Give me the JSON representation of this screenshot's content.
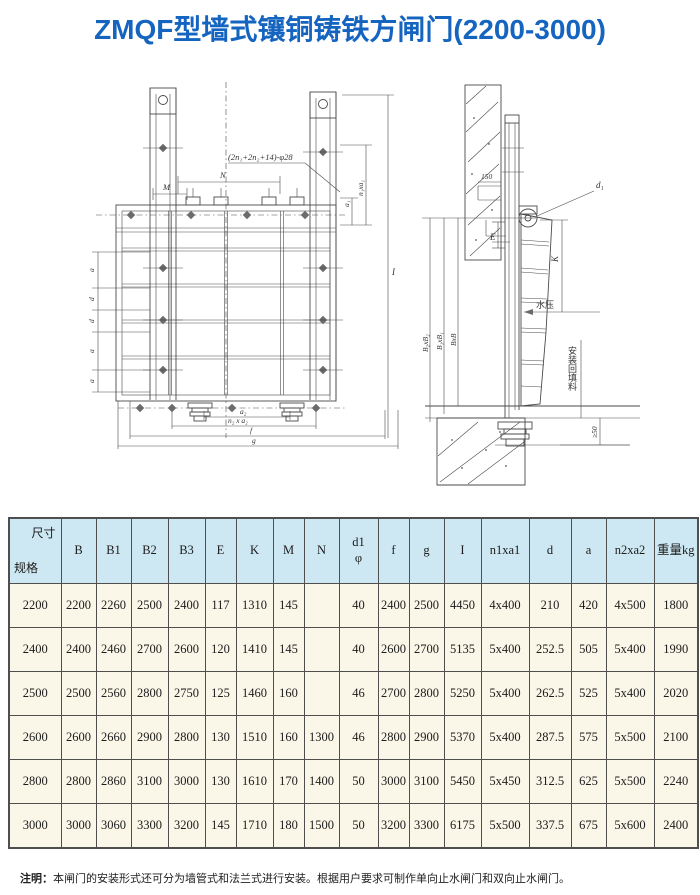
{
  "page": {
    "title": "ZMQF型墙式镶铜铸铁方闸门(2200-3000)"
  },
  "drawing": {
    "front_view": {
      "labels": {
        "bolt_note": "(2n₁+2n₂+14)-φ28",
        "dim_m": "M",
        "dim_n": "N",
        "left_dims": [
          "a",
          "d",
          "d",
          "a",
          "a"
        ],
        "right_dim_short": "a₁",
        "right_dim_tall": "n₁xa₁",
        "total_height": "I",
        "dim_a2": "a₂",
        "dim_n2a2": "n₂ x a₂",
        "dim_f": "f",
        "dim_g": "g"
      }
    },
    "section_view": {
      "labels": {
        "recess": "150",
        "hinge": "d₁",
        "dim_e": "E",
        "dim_k": "K",
        "water_pressure": "水压",
        "width_dims": [
          "B₂xB₂",
          "B₁xB₁",
          "BxB"
        ],
        "backfill": "安装回填料",
        "clearance": "≥50"
      }
    }
  },
  "table": {
    "corner_top": "尺寸",
    "corner_bottom": "规格",
    "headers": [
      "B",
      "B1",
      "B2",
      "B3",
      "E",
      "K",
      "M",
      "N",
      "d1\nφ",
      "f",
      "g",
      "I",
      "n1xa1",
      "d",
      "a",
      "n2xa2",
      "重量kg"
    ],
    "rows": [
      [
        "2200",
        "2200",
        "2260",
        "2500",
        "2400",
        "117",
        "1310",
        "145",
        "",
        "40",
        "2400",
        "2500",
        "4450",
        "4x400",
        "210",
        "420",
        "4x500",
        "1800"
      ],
      [
        "2400",
        "2400",
        "2460",
        "2700",
        "2600",
        "120",
        "1410",
        "145",
        "",
        "40",
        "2600",
        "2700",
        "5135",
        "5x400",
        "252.5",
        "505",
        "5x400",
        "1990"
      ],
      [
        "2500",
        "2500",
        "2560",
        "2800",
        "2750",
        "125",
        "1460",
        "160",
        "",
        "46",
        "2700",
        "2800",
        "5250",
        "5x400",
        "262.5",
        "525",
        "5x400",
        "2020"
      ],
      [
        "2600",
        "2600",
        "2660",
        "2900",
        "2800",
        "130",
        "1510",
        "160",
        "1300",
        "46",
        "2800",
        "2900",
        "5370",
        "5x400",
        "287.5",
        "575",
        "5x500",
        "2100"
      ],
      [
        "2800",
        "2800",
        "2860",
        "3100",
        "3000",
        "130",
        "1610",
        "170",
        "1400",
        "50",
        "3000",
        "3100",
        "5450",
        "5x450",
        "312.5",
        "625",
        "5x500",
        "2240"
      ],
      [
        "3000",
        "3000",
        "3060",
        "3300",
        "3200",
        "145",
        "1710",
        "180",
        "1500",
        "50",
        "3200",
        "3300",
        "6175",
        "5x500",
        "337.5",
        "675",
        "5x600",
        "2400"
      ]
    ]
  },
  "note": {
    "label": "注明：",
    "text": "本闸门的安装形式还可分为墙管式和法兰式进行安装。根据用户要求可制作单向止水闸门和双向止水闸门。"
  }
}
